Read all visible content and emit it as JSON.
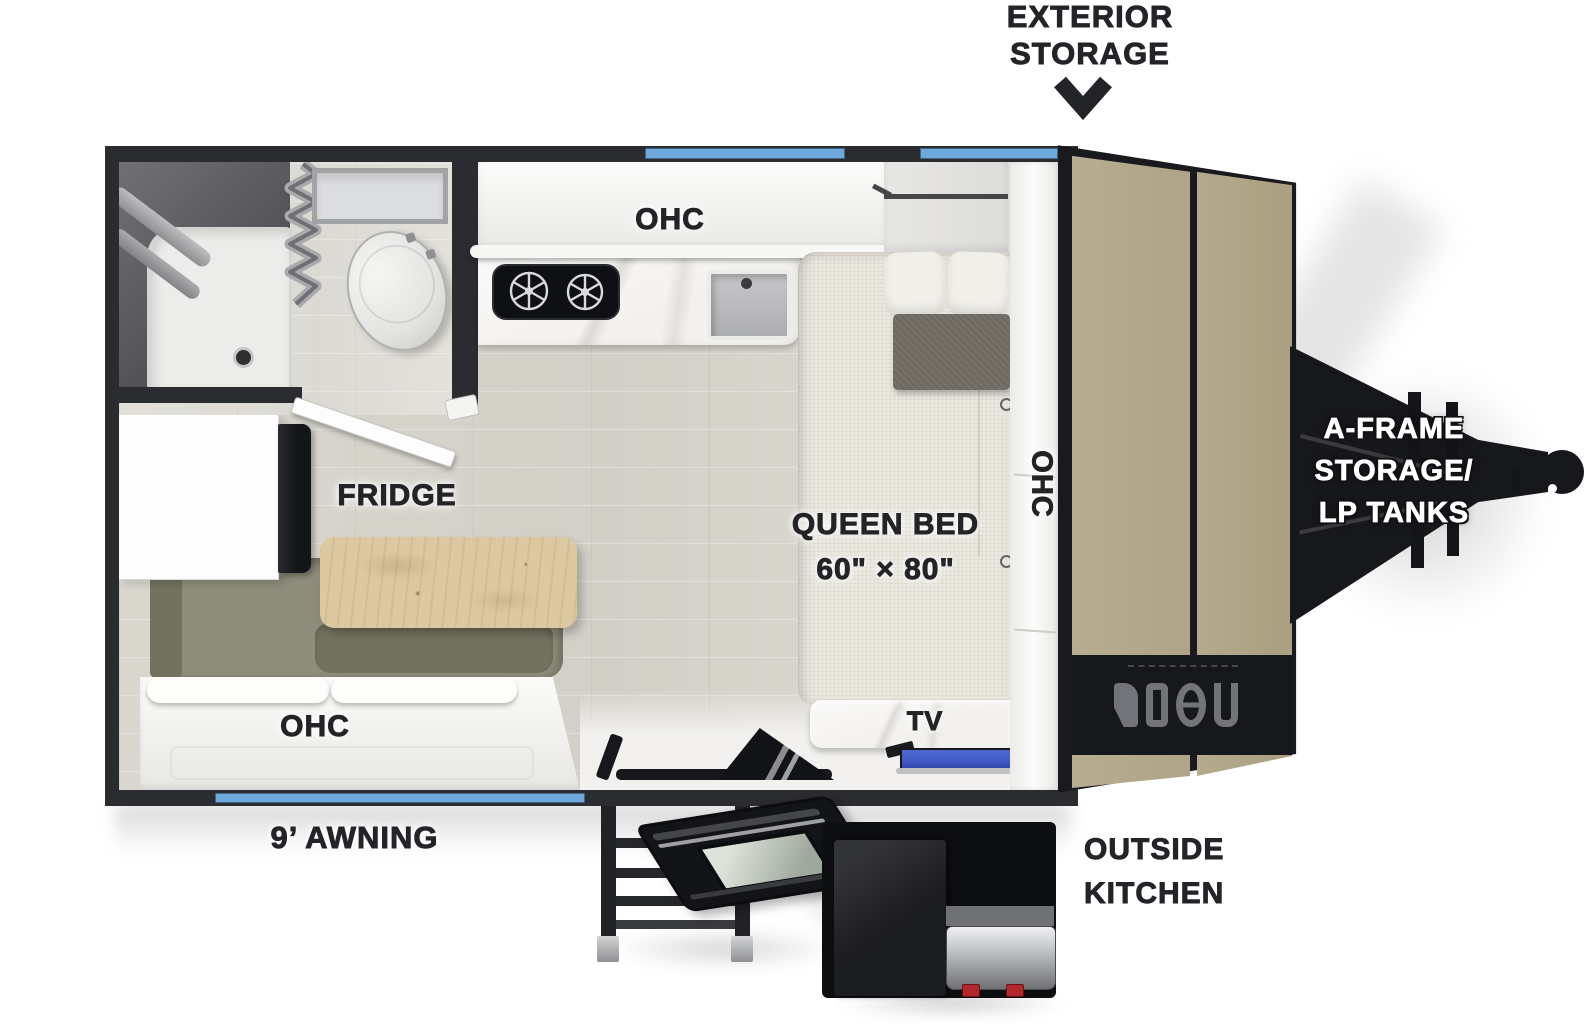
{
  "floorplan": {
    "exterior_storage": {
      "line1": "EXTERIOR",
      "line2": "STORAGE"
    },
    "kitchen_ohc": "OHC",
    "dinette_ohc": "OHC",
    "front_ohc": "OHC",
    "fridge": "FRIDGE",
    "queen_bed": {
      "line1": "QUEEN BED",
      "line2": "60\" × 80\""
    },
    "tv": "TV",
    "awning": "9’ AWNING",
    "outside_kitchen": {
      "line1": "OUTSIDE",
      "line2": "KITCHEN"
    },
    "a_frame": {
      "line1": "A-FRAME",
      "line2": "STORAGE/",
      "line3": "LP TANKS"
    }
  },
  "colors": {
    "wall": "#2b2c2f",
    "window_blue": "#6fa9dc",
    "floor": "#d8d5cd",
    "floor_light": "#e6e4de",
    "marble": "#f3f1ee",
    "bed": "#eae7df",
    "pillow": "#f1efe9",
    "cushion": "#6f6a61",
    "bench": "#8e8d7b",
    "bench_dark": "#73725f",
    "table_wood": "#dcc9a1",
    "tan_door": "#b8ad90",
    "black_part": "#17181b",
    "tv_blue": "#4059c7",
    "knob_red": "#b1272c",
    "label_ink": "#232428"
  }
}
